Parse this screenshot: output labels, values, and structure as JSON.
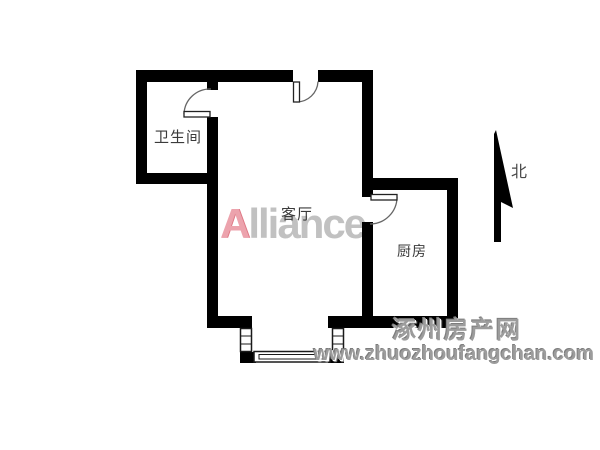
{
  "floorplan": {
    "rooms": [
      {
        "id": "bathroom",
        "label": "卫生间"
      },
      {
        "id": "living-room",
        "label": "客厅"
      },
      {
        "id": "kitchen",
        "label": "厨房"
      }
    ],
    "north_label": "北"
  },
  "watermarks": {
    "brand_first_letter": "A",
    "brand_rest": "lliance",
    "site_name": "涿州房产网",
    "site_url": "www.zhuozhoufangchan.com"
  },
  "colors": {
    "wall": "#000000",
    "room_text": "#3b3b3b",
    "brand_a": "#e9939f",
    "brand_gray": "#b7b7b7",
    "watermark_gray": "#9c9c9c",
    "background": "#ffffff"
  }
}
